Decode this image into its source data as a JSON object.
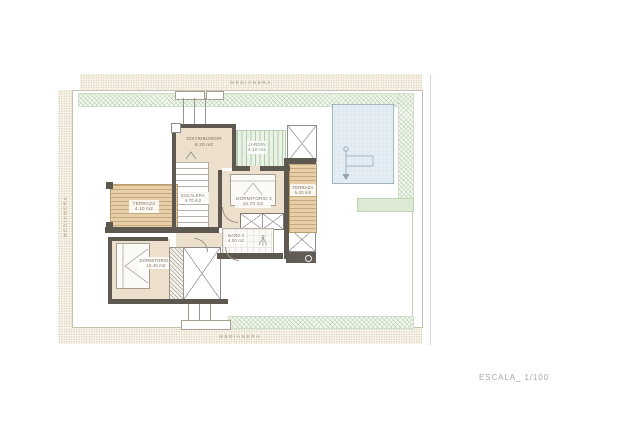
{
  "drawing": {
    "scale_label": "ESCALA_ 1/100"
  },
  "site": {
    "medianera_top": "MEDIANERA",
    "medianera_left": "MEDIANERA",
    "medianera_bottom": "MEDIANERA"
  },
  "rooms": {
    "distribuidor": {
      "name": "DISTRIBUIDOR",
      "area": "8.20 m2"
    },
    "jardin": {
      "name": "JARDÍN",
      "area": "4.10 m2"
    },
    "escalera": {
      "name": "ESCALERA",
      "area": "4.70 m2"
    },
    "terraza_izq": {
      "name": "TERRAZA",
      "area": "4.10 m2"
    },
    "dormitorio2": {
      "name": "DORMITORIO 2",
      "area": "16.70 m2"
    },
    "terraza_der": {
      "name": "TERRAZA",
      "area": "5.20 m2"
    },
    "bano2": {
      "name": "BAÑO 2",
      "area": "4.00 m2"
    },
    "dormitorio3": {
      "name": "DORMITORIO 3",
      "area": "10.40 m2"
    }
  },
  "colors": {
    "wall": "#5d5850",
    "floor": "#ece0cd",
    "deck": "#e7d0a9",
    "pool": "#e4edf4",
    "garden_hatch": "#9ab98f",
    "stipple_band": "#d5c9b2",
    "scale_text": "#a7a7a7"
  }
}
